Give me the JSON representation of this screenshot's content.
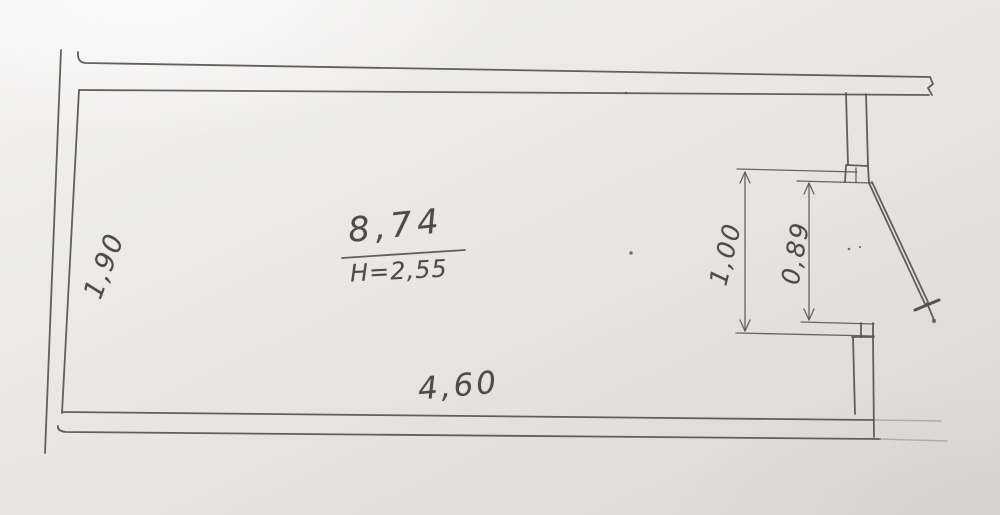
{
  "drawing": {
    "room": {
      "area_label": "8,74",
      "height_label": "H=2,55",
      "bottom_width_label": "4,60",
      "left_depth_label": "1,90"
    },
    "door": {
      "opening_width_label": "1,00",
      "clear_width_label": "0,89"
    },
    "colors": {
      "ink": "#57534e",
      "handwriting": "#4e4a45",
      "paper": "#e9e7e5"
    }
  }
}
